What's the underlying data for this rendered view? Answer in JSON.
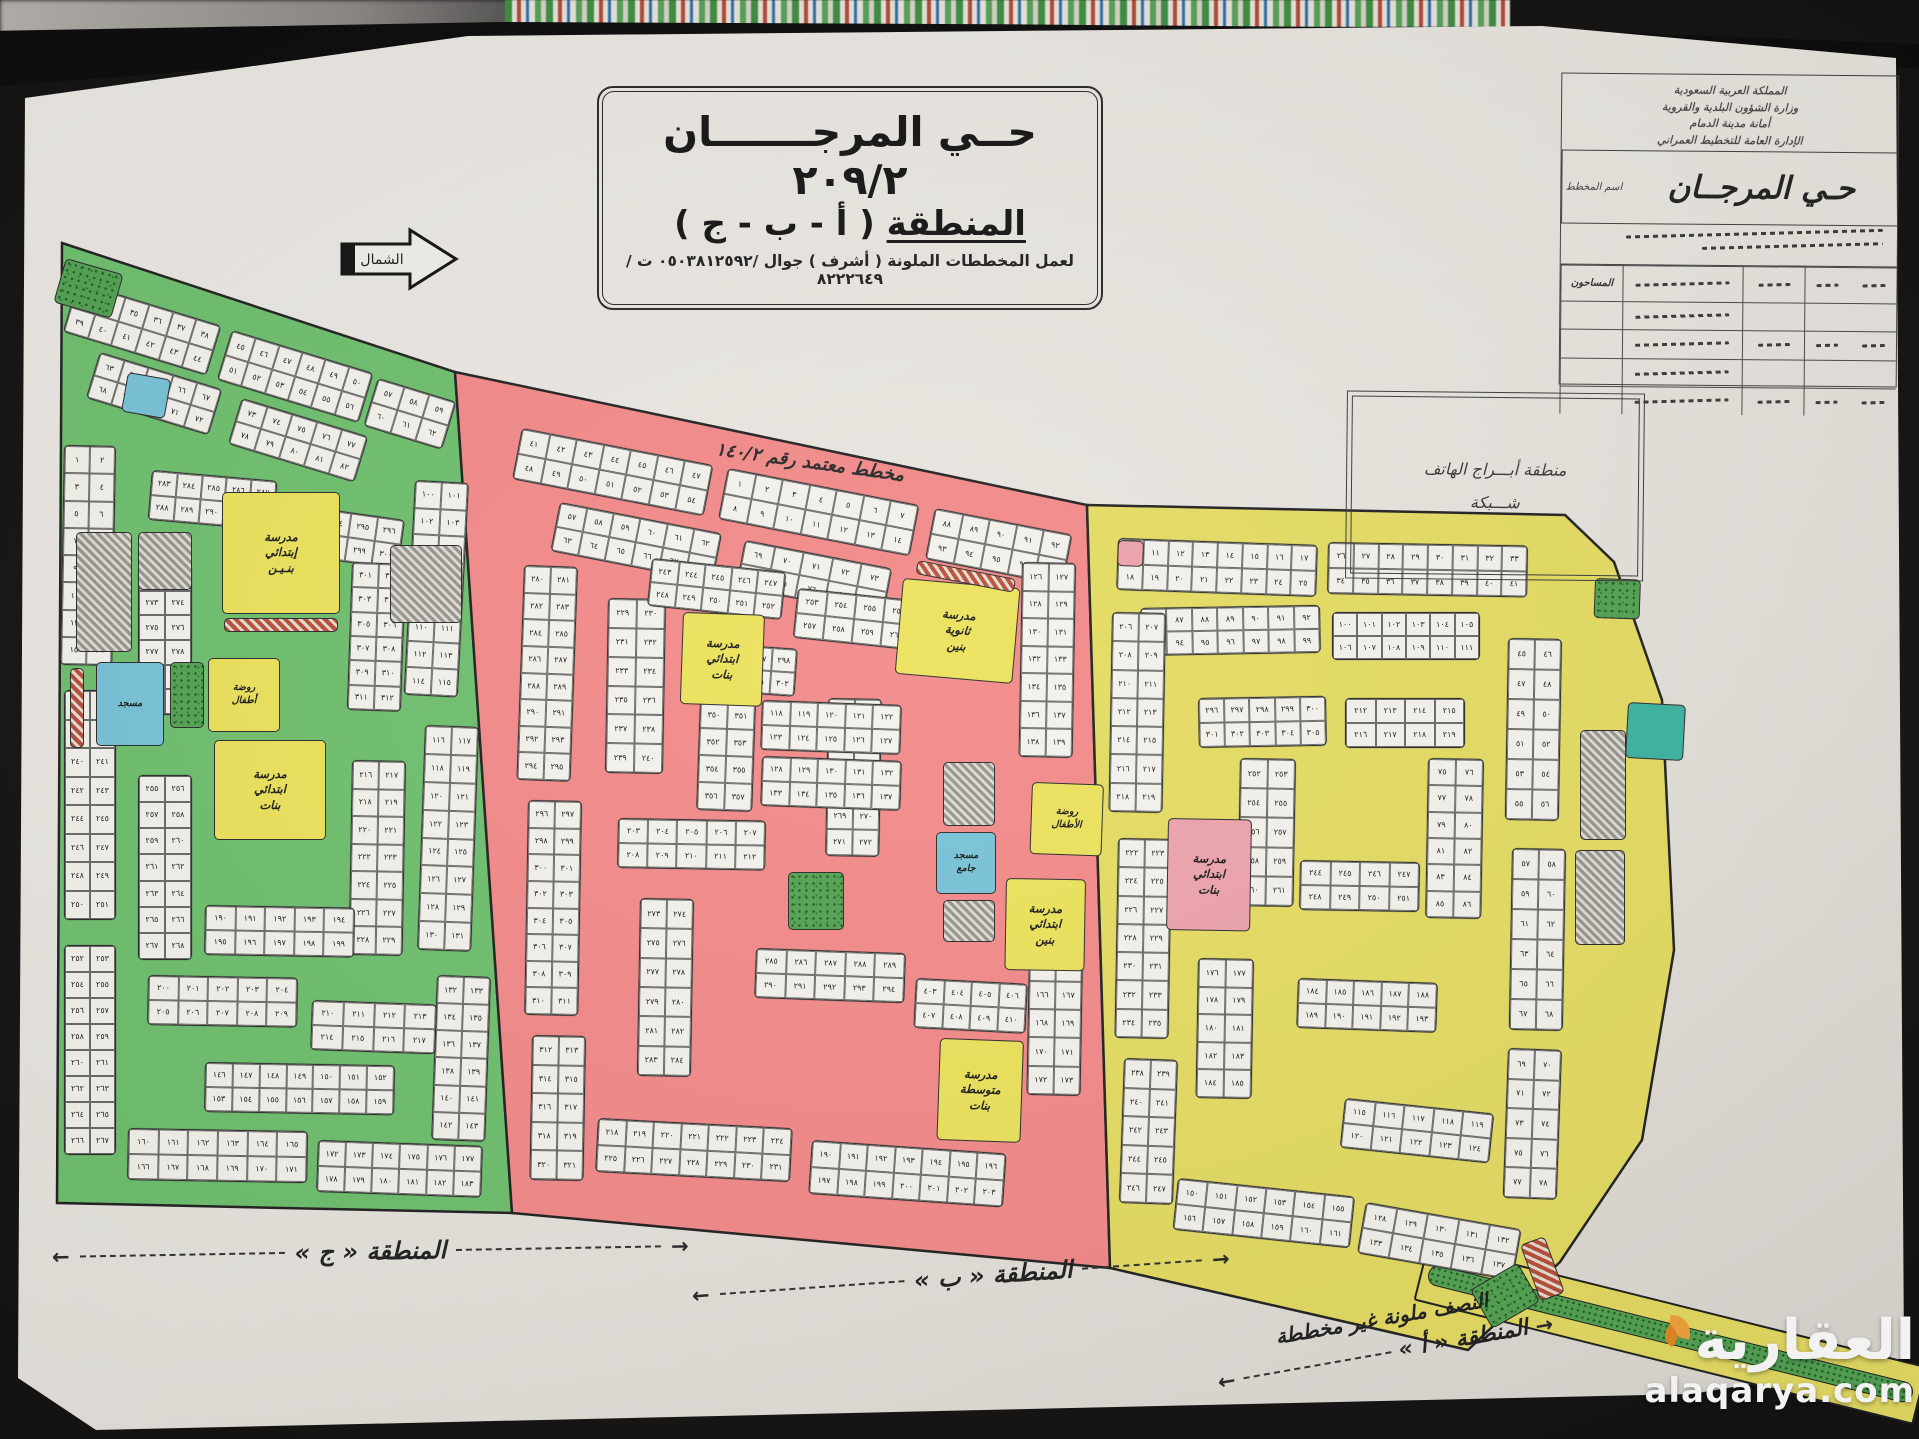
{
  "scene": {
    "background": "#151413",
    "paper": "#e8e5df"
  },
  "header": {
    "title_line1": "حــي المرجـــــــان ٢٠٩/٢",
    "title_line2_word": "المنطقة",
    "title_line2_rest": "( أ - ب - ج )",
    "title_line3": "لعمل المخططات الملونة ( أشرف ) جوال /٠٥٠٣٨١٢٥٩٢ ت /٨٢٢٢٦٤٩"
  },
  "north": {
    "label": "الشمال"
  },
  "approval_note": "مخطط معتمد رقم ١٤٠/٢",
  "phone_box": {
    "line1": "منطقة أبـــراج الهاتف",
    "line2": "شـــبكة"
  },
  "info_block": {
    "header_lines": [
      "المملكة العربية السعودية",
      "وزارة الشؤون البلدية والقروية",
      "أمانة مدينة الدمام",
      "الإدارة العامة للتخطيط العمراني"
    ],
    "plan_label": "اسم المخطط",
    "plan_name": "حـي المرجــان",
    "surveyors_label": "المساحون",
    "table_rows": 5,
    "table_cols": 5
  },
  "zone_captions": {
    "c": "المنطقة « ج »",
    "b": "المنطقة « ب »",
    "a_line1": "النصف ملونة غير مخططة",
    "a_line2": "المنطقة « أ »"
  },
  "watermark": {
    "name": "العقارية",
    "domain": "alaqarya.com",
    "accent": "#f2a33c"
  },
  "map": {
    "exit_road": {
      "x": 1428,
      "y": 1242,
      "w": 515,
      "h": 60,
      "rot": 14
    },
    "zones": [
      {
        "id": "c",
        "name": "المنطقة ج",
        "street_color": "#6fc06f",
        "outline": "62,243 455,372 512,1213 57,1203",
        "blocks": [
          [
            78,
            282,
            150,
            52,
            2,
            6,
            33,
            17
          ],
          [
            232,
            330,
            148,
            52,
            2,
            6,
            45,
            17
          ],
          [
            378,
            378,
            82,
            50,
            2,
            3,
            57,
            17
          ],
          [
            100,
            352,
            128,
            48,
            2,
            5,
            63,
            17
          ],
          [
            242,
            398,
            132,
            48,
            2,
            5,
            73,
            17
          ],
          [
            64,
            445,
            52,
            220,
            8,
            2,
            1,
            1
          ],
          [
            64,
            690,
            52,
            230,
            8,
            2,
            236,
            0
          ],
          [
            64,
            945,
            52,
            210,
            8,
            2,
            252,
            0
          ],
          [
            128,
            1128,
            180,
            52,
            2,
            6,
            160,
            1
          ],
          [
            318,
            1140,
            165,
            52,
            2,
            6,
            172,
            2
          ],
          [
            415,
            480,
            54,
            215,
            8,
            2,
            100,
            3
          ],
          [
            425,
            725,
            54,
            225,
            8,
            2,
            116,
            2
          ],
          [
            437,
            975,
            54,
            165,
            6,
            2,
            132,
            2
          ],
          [
            152,
            470,
            126,
            50,
            2,
            5,
            283,
            5
          ],
          [
            298,
            505,
            108,
            50,
            2,
            4,
            293,
            8
          ],
          [
            138,
            565,
            54,
            150,
            6,
            2,
            271,
            0
          ],
          [
            352,
            562,
            54,
            148,
            6,
            2,
            301,
            2
          ],
          [
            148,
            975,
            150,
            50,
            2,
            5,
            200,
            1
          ],
          [
            312,
            1000,
            125,
            50,
            2,
            4,
            210,
            2
          ],
          [
            138,
            775,
            54,
            185,
            7,
            2,
            255,
            0
          ],
          [
            352,
            760,
            54,
            195,
            7,
            2,
            216,
            1
          ],
          [
            205,
            905,
            150,
            50,
            2,
            5,
            190,
            1
          ],
          [
            205,
            1062,
            190,
            50,
            2,
            7,
            146,
            1
          ]
        ],
        "features": [
          {
            "t": "school",
            "x": 222,
            "y": 492,
            "w": 118,
            "h": 122,
            "label": "مدرسة\nإبتدائي\nبنـيـن"
          },
          {
            "t": "hatch-red",
            "x": 224,
            "y": 618,
            "w": 114,
            "h": 14
          },
          {
            "t": "kg",
            "x": 208,
            "y": 658,
            "w": 72,
            "h": 74,
            "label": "روضة\nأطفال"
          },
          {
            "t": "mosque",
            "x": 96,
            "y": 662,
            "w": 68,
            "h": 84,
            "label": "مسجد"
          },
          {
            "t": "park",
            "x": 170,
            "y": 662,
            "w": 34,
            "h": 66
          },
          {
            "t": "school",
            "x": 214,
            "y": 740,
            "w": 112,
            "h": 100,
            "label": "مدرسة\nابتدائي\nبنات"
          },
          {
            "t": "hatch-gray",
            "x": 76,
            "y": 532,
            "w": 56,
            "h": 120
          },
          {
            "t": "hatch-gray",
            "x": 138,
            "y": 532,
            "w": 54,
            "h": 58
          },
          {
            "t": "park",
            "x": 66,
            "y": 258,
            "w": 60,
            "h": 46,
            "rot": 16
          },
          {
            "t": "mosque",
            "x": 128,
            "y": 372,
            "w": 44,
            "h": 40,
            "rot": 10
          },
          {
            "t": "hatch-gray",
            "x": 390,
            "y": 545,
            "w": 72,
            "h": 78
          },
          {
            "t": "hatch-red",
            "x": 70,
            "y": 668,
            "w": 14,
            "h": 80
          }
        ]
      },
      {
        "id": "b",
        "name": "المنطقة ب",
        "street_color": "#f38a8a",
        "outline": "455,372 1087,505 1110,1268 512,1213",
        "blocks": [
          [
            522,
            428,
            195,
            52,
            2,
            7,
            41,
            11
          ],
          [
            728,
            468,
            195,
            52,
            2,
            7,
            1,
            11
          ],
          [
            935,
            508,
            140,
            52,
            2,
            5,
            88,
            11
          ],
          [
            560,
            502,
            165,
            50,
            2,
            6,
            57,
            11
          ],
          [
            745,
            540,
            150,
            48,
            2,
            5,
            69,
            11
          ],
          [
            524,
            565,
            54,
            215,
            8,
            2,
            280,
            2
          ],
          [
            528,
            800,
            54,
            215,
            8,
            2,
            296,
            1
          ],
          [
            532,
            1035,
            54,
            145,
            5,
            2,
            312,
            1
          ],
          [
            598,
            1118,
            195,
            54,
            2,
            7,
            218,
            3
          ],
          [
            812,
            1140,
            195,
            54,
            2,
            7,
            190,
            4
          ],
          [
            1022,
            562,
            54,
            195,
            7,
            2,
            126,
            1
          ],
          [
            1030,
            895,
            54,
            200,
            7,
            2,
            160,
            1
          ],
          [
            608,
            598,
            58,
            175,
            6,
            2,
            229,
            1
          ],
          [
            618,
            818,
            148,
            50,
            2,
            5,
            203,
            1
          ],
          [
            652,
            558,
            135,
            48,
            2,
            5,
            243,
            6
          ],
          [
            798,
            588,
            118,
            50,
            2,
            4,
            253,
            6
          ],
          [
            828,
            698,
            54,
            158,
            6,
            2,
            261,
            1
          ],
          [
            640,
            898,
            54,
            178,
            6,
            2,
            273,
            1
          ],
          [
            756,
            948,
            150,
            50,
            2,
            5,
            285,
            2
          ],
          [
            916,
            978,
            112,
            50,
            2,
            4,
            403,
            3
          ],
          [
            700,
            642,
            98,
            48,
            2,
            4,
            295,
            4
          ],
          [
            700,
            700,
            56,
            110,
            4,
            2,
            350,
            2
          ],
          [
            762,
            700,
            140,
            50,
            2,
            5,
            118,
            2
          ],
          [
            762,
            756,
            140,
            50,
            2,
            5,
            128,
            2
          ]
        ],
        "features": [
          {
            "t": "school",
            "x": 903,
            "y": 578,
            "w": 118,
            "h": 96,
            "label": "مدرسة\nثانوية\nبنين",
            "rot": 5
          },
          {
            "t": "school",
            "x": 683,
            "y": 612,
            "w": 82,
            "h": 92,
            "label": "مدرسة\nابتدائي\nبنات",
            "rot": 2
          },
          {
            "t": "kg",
            "x": 1032,
            "y": 782,
            "w": 72,
            "h": 72,
            "label": "روضة\nالأطفال",
            "rot": 2
          },
          {
            "t": "mosque",
            "x": 936,
            "y": 832,
            "w": 60,
            "h": 62,
            "label": "مسجد\nجامع"
          },
          {
            "t": "school",
            "x": 1006,
            "y": 878,
            "w": 80,
            "h": 92,
            "label": "مدرسة\nابتدائي\nبنين",
            "rot": 1
          },
          {
            "t": "school",
            "x": 940,
            "y": 1038,
            "w": 84,
            "h": 102,
            "label": "مدرسة\nمتوسطة\nبنات",
            "rot": 2
          },
          {
            "t": "hatch-gray",
            "x": 943,
            "y": 762,
            "w": 52,
            "h": 64
          },
          {
            "t": "hatch-gray",
            "x": 943,
            "y": 900,
            "w": 52,
            "h": 42
          },
          {
            "t": "park",
            "x": 788,
            "y": 872,
            "w": 56,
            "h": 58
          },
          {
            "t": "hatch-red",
            "x": 918,
            "y": 560,
            "w": 100,
            "h": 14,
            "rot": 11
          }
        ]
      },
      {
        "id": "a",
        "name": "المنطقة أ",
        "street_color": "#e5dc63",
        "outline": "1087,505 1565,515 1614,562 1662,700 1674,950 1642,1140 1560,1262 1468,1350 1110,1268",
        "blocks": [
          [
            1118,
            538,
            200,
            52,
            2,
            8,
            10,
            2
          ],
          [
            1328,
            542,
            200,
            52,
            2,
            8,
            26,
            1
          ],
          [
            1140,
            608,
            180,
            48,
            2,
            7,
            86,
            -1
          ],
          [
            1332,
            612,
            148,
            48,
            2,
            6,
            100,
            0
          ],
          [
            1112,
            612,
            54,
            200,
            7,
            2,
            206,
            1
          ],
          [
            1118,
            838,
            54,
            200,
            7,
            2,
            222,
            1
          ],
          [
            1124,
            1058,
            54,
            145,
            5,
            2,
            238,
            2
          ],
          [
            1508,
            638,
            54,
            182,
            6,
            2,
            45,
            1
          ],
          [
            1512,
            848,
            54,
            182,
            6,
            2,
            57,
            1
          ],
          [
            1508,
            1048,
            54,
            150,
            5,
            2,
            69,
            2
          ],
          [
            1178,
            1178,
            178,
            52,
            2,
            6,
            150,
            6
          ],
          [
            1366,
            1202,
            158,
            52,
            2,
            5,
            128,
            10
          ],
          [
            1198,
            698,
            128,
            50,
            2,
            5,
            296,
            -1
          ],
          [
            1345,
            698,
            120,
            50,
            2,
            4,
            212,
            0
          ],
          [
            1198,
            958,
            56,
            140,
            5,
            2,
            176,
            1
          ],
          [
            1298,
            978,
            140,
            50,
            2,
            5,
            184,
            2
          ],
          [
            1428,
            758,
            56,
            160,
            6,
            2,
            75,
            1
          ],
          [
            1240,
            758,
            56,
            148,
            5,
            2,
            252,
            1
          ],
          [
            1300,
            860,
            120,
            50,
            2,
            4,
            244,
            1
          ],
          [
            1345,
            1098,
            150,
            50,
            2,
            5,
            115,
            6
          ]
        ],
        "features": [
          {
            "t": "school-pink",
            "x": 1168,
            "y": 818,
            "w": 84,
            "h": 112,
            "label": "مدرسة\nابتدائي\nبنات",
            "rot": 1
          },
          {
            "t": "mosque-teal",
            "x": 1628,
            "y": 702,
            "w": 58,
            "h": 56,
            "rot": 3
          },
          {
            "t": "hatch-gray",
            "x": 1580,
            "y": 730,
            "w": 46,
            "h": 110
          },
          {
            "t": "hatch-gray",
            "x": 1575,
            "y": 850,
            "w": 50,
            "h": 95
          },
          {
            "t": "park",
            "x": 1595,
            "y": 578,
            "w": 46,
            "h": 40,
            "rot": 2
          },
          {
            "t": "school-pink",
            "x": 1118,
            "y": 540,
            "w": 26,
            "h": 26,
            "rot": 2
          },
          {
            "t": "park",
            "x": 1470,
            "y": 1290,
            "w": 55,
            "h": 45,
            "rot": -30
          },
          {
            "t": "hatch-red",
            "x": 1520,
            "y": 1245,
            "w": 26,
            "h": 60,
            "rot": -20
          }
        ]
      }
    ]
  }
}
